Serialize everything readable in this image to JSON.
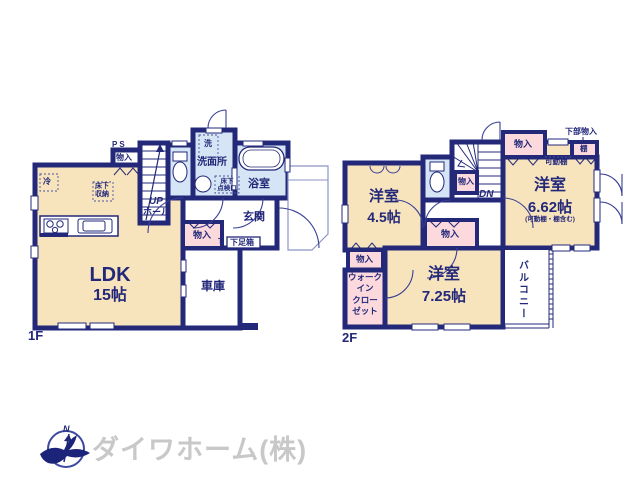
{
  "colors": {
    "wall": "#232879",
    "room_cream": "#f7e4bd",
    "closet_pink": "#fbd9dc",
    "wet_blue": "#d6e5f5",
    "thin_line": "#8d95c6",
    "label_navy": "#232879",
    "logo_gray": "#c8c8c8"
  },
  "floor1": {
    "label": "1F",
    "ldk": {
      "name": "LDK",
      "size": "15帖"
    },
    "garage": "車庫",
    "entrance": "玄関",
    "bath": "浴室",
    "washroom": "洗面所",
    "laundry": "洗",
    "fridge": "冷",
    "underfloor_storage": "床下\n収納",
    "inspection_hatch": "床下\n点検口",
    "ps": "PS",
    "closet_nook": "物入",
    "closet": "物入",
    "shoebox_t": "T",
    "shoebox": "下足箱",
    "up": "UP",
    "hall": "ホール"
  },
  "floor2": {
    "label": "2F",
    "room_45": {
      "name": "洋室",
      "size": "4.5帖"
    },
    "room_662": {
      "name": "洋室",
      "size": "6.62帖",
      "note": "(可動棚・棚含む)"
    },
    "room_725": {
      "name": "洋室",
      "size": "7.25帖"
    },
    "walk_in_closet": "ウォーク\nイン\nクロー\nゼット",
    "balcony": "バルコニー",
    "down": "DN",
    "closet_by_stairs": "物入",
    "closet_top_right": "物入",
    "closet_mid": "物入",
    "closet_left": "物入",
    "shelf": "棚",
    "movable_shelf": "可動棚",
    "lower_storage": "下部物入"
  },
  "footer": {
    "company": "ダイワホーム(株)",
    "compass_north": "N"
  }
}
